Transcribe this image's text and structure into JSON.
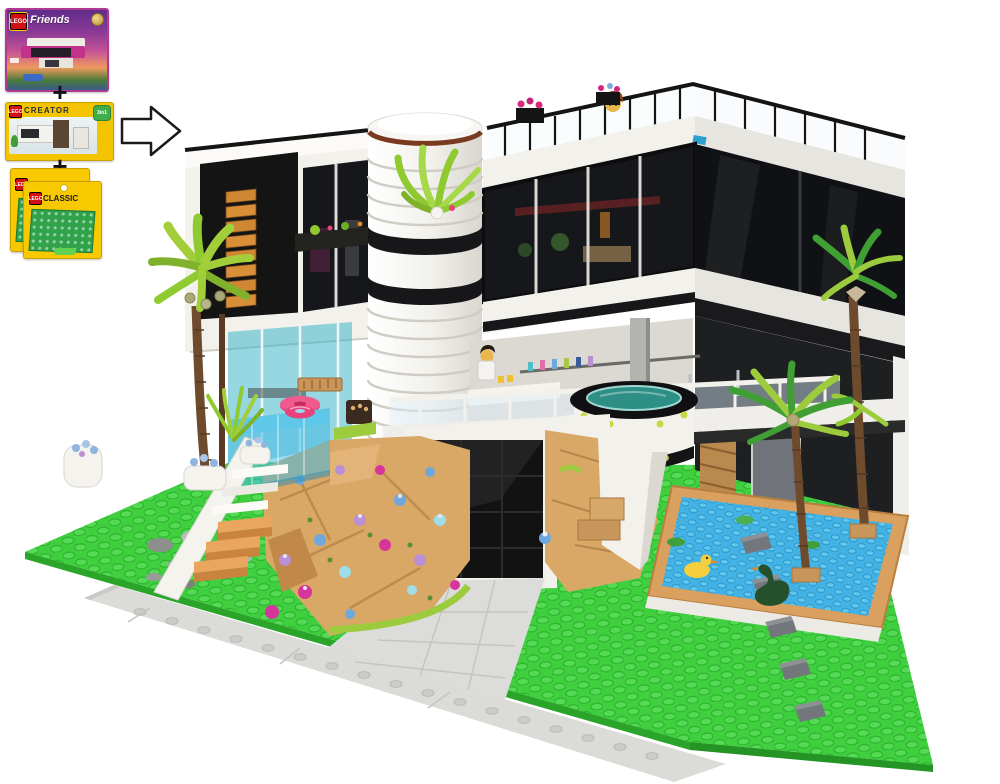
{
  "page": {
    "background": "#ffffff",
    "subject": "LEGO MOC modern black-and-white villa with pools and palm trees, built by combining three LEGO sets",
    "composition": "three product boxes joined by plus signs, with an outline arrow pointing to the finished model photo"
  },
  "recipe": {
    "brand": "LEGO",
    "plus": "+",
    "arrow_icon": "right-arrow",
    "boxes": [
      {
        "series": "Friends",
        "description": "purple sunset box showing a modern mansion",
        "accent": "#8c3a96",
        "badge": ""
      },
      {
        "series": "CREATOR",
        "description": "yellow box showing a modern house",
        "accent": "#f5c400",
        "badge": "3in1"
      },
      {
        "series": "CLASSIC",
        "description": "green baseplate pack, two copies stacked",
        "accent": "#f8c800",
        "badge": "",
        "quantity": 2
      }
    ]
  },
  "scene": {
    "elements": [
      "green studded baseplate",
      "light gray sidewalk with studs",
      "gray stepping stones",
      "modern villa",
      "white ribbed cylindrical tower",
      "black glass upper floor",
      "roof terrace with railing",
      "minifigure peeking over roof railing",
      "roof planters with magenta flowers",
      "black facade with orange louvers",
      "elevated glass pool with pink ring float",
      "white and tan staircase",
      "rock garden with purple blue and pink flowers",
      "black garage door",
      "light gray tiled driveway",
      "cantilevered round jacuzzi",
      "balcony bar with minifigure and bottles",
      "azure duck pond with tan border",
      "yellow duck",
      "lily pads",
      "dark green goose",
      "stepping tiles",
      "left palm tree with coconuts",
      "two right palm trees",
      "white planters with blue flowers"
    ],
    "palette": {
      "lawn_green": "#3fcf3f",
      "stud_green": "#55da55",
      "pond_azure": "#43b2e4",
      "pond_border_tan": "#d9a05f",
      "house_black": "#141414",
      "house_white": "#f2f1ec",
      "louver_orange": "#cf8733",
      "glass_teal": "#2dafc3",
      "pool_blue": "#57c8e8",
      "float_pink": "#e8427a",
      "rock_tan": "#d9a766",
      "flower_lavender": "#b98fd6",
      "flower_magenta": "#d6369b",
      "flower_azure": "#6fa8dc",
      "palm_leaf": "#a2ce39",
      "palm_trunk": "#6f4b2e",
      "duck_yellow": "#f5cf3e",
      "sidewalk_gray": "#dbdbd8",
      "jacuzzi_water": "#2e8f86",
      "lego_red": "#d01012"
    }
  }
}
